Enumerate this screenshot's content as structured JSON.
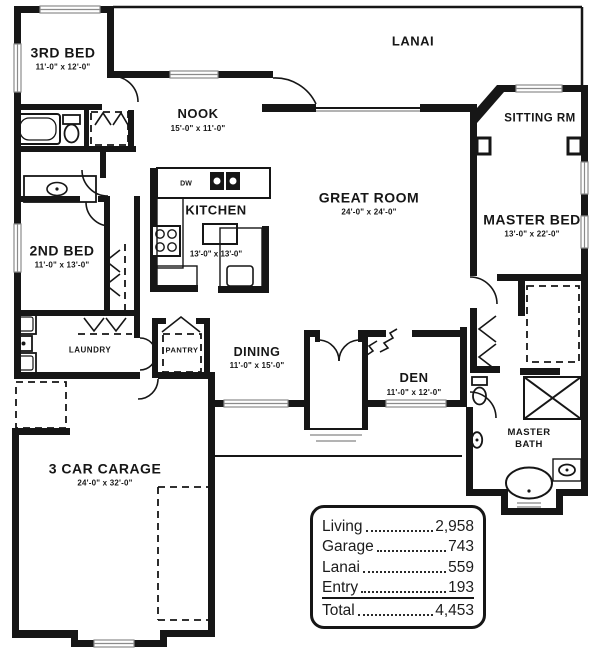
{
  "rooms": [
    {
      "name": "LANAI",
      "dims": ""
    },
    {
      "name": "3RD BED",
      "dims": "11'-0\" x 12'-0\""
    },
    {
      "name": "NOOK",
      "dims": "15'-0\" x 11'-0\""
    },
    {
      "name": "SITTING RM",
      "dims": ""
    },
    {
      "name": "KITCHEN",
      "dims": "13'-0\" x 13'-0\""
    },
    {
      "name": "GREAT ROOM",
      "dims": "24'-0\" x 24'-0\""
    },
    {
      "name": "MASTER BED",
      "dims": "13'-0\" x 22'-0\""
    },
    {
      "name": "2ND BED",
      "dims": "11'-0\" x 13'-0\""
    },
    {
      "name": "LAUNDRY",
      "dims": ""
    },
    {
      "name": "PANTRY",
      "dims": ""
    },
    {
      "name": "DINING",
      "dims": "11'-0\" x 15'-0\""
    },
    {
      "name": "DEN",
      "dims": "11'-0\" x 12'-0\""
    },
    {
      "name": "MASTER BATH",
      "dims": ""
    },
    {
      "name": "3 CAR CARAGE",
      "dims": "24'-0\" x 32'-0\""
    }
  ],
  "appliance_labels": {
    "dishwasher": "DW"
  },
  "area_table": {
    "rows": [
      {
        "label": "Living",
        "value": "2,958"
      },
      {
        "label": "Garage",
        "value": "743"
      },
      {
        "label": "Lanai",
        "value": "559"
      },
      {
        "label": "Entry",
        "value": "193"
      },
      {
        "label": "Total",
        "value": "4,453"
      }
    ]
  },
  "colors": {
    "ink": "#161616",
    "window_line": "#9a9a9a",
    "background": "#ffffff"
  }
}
